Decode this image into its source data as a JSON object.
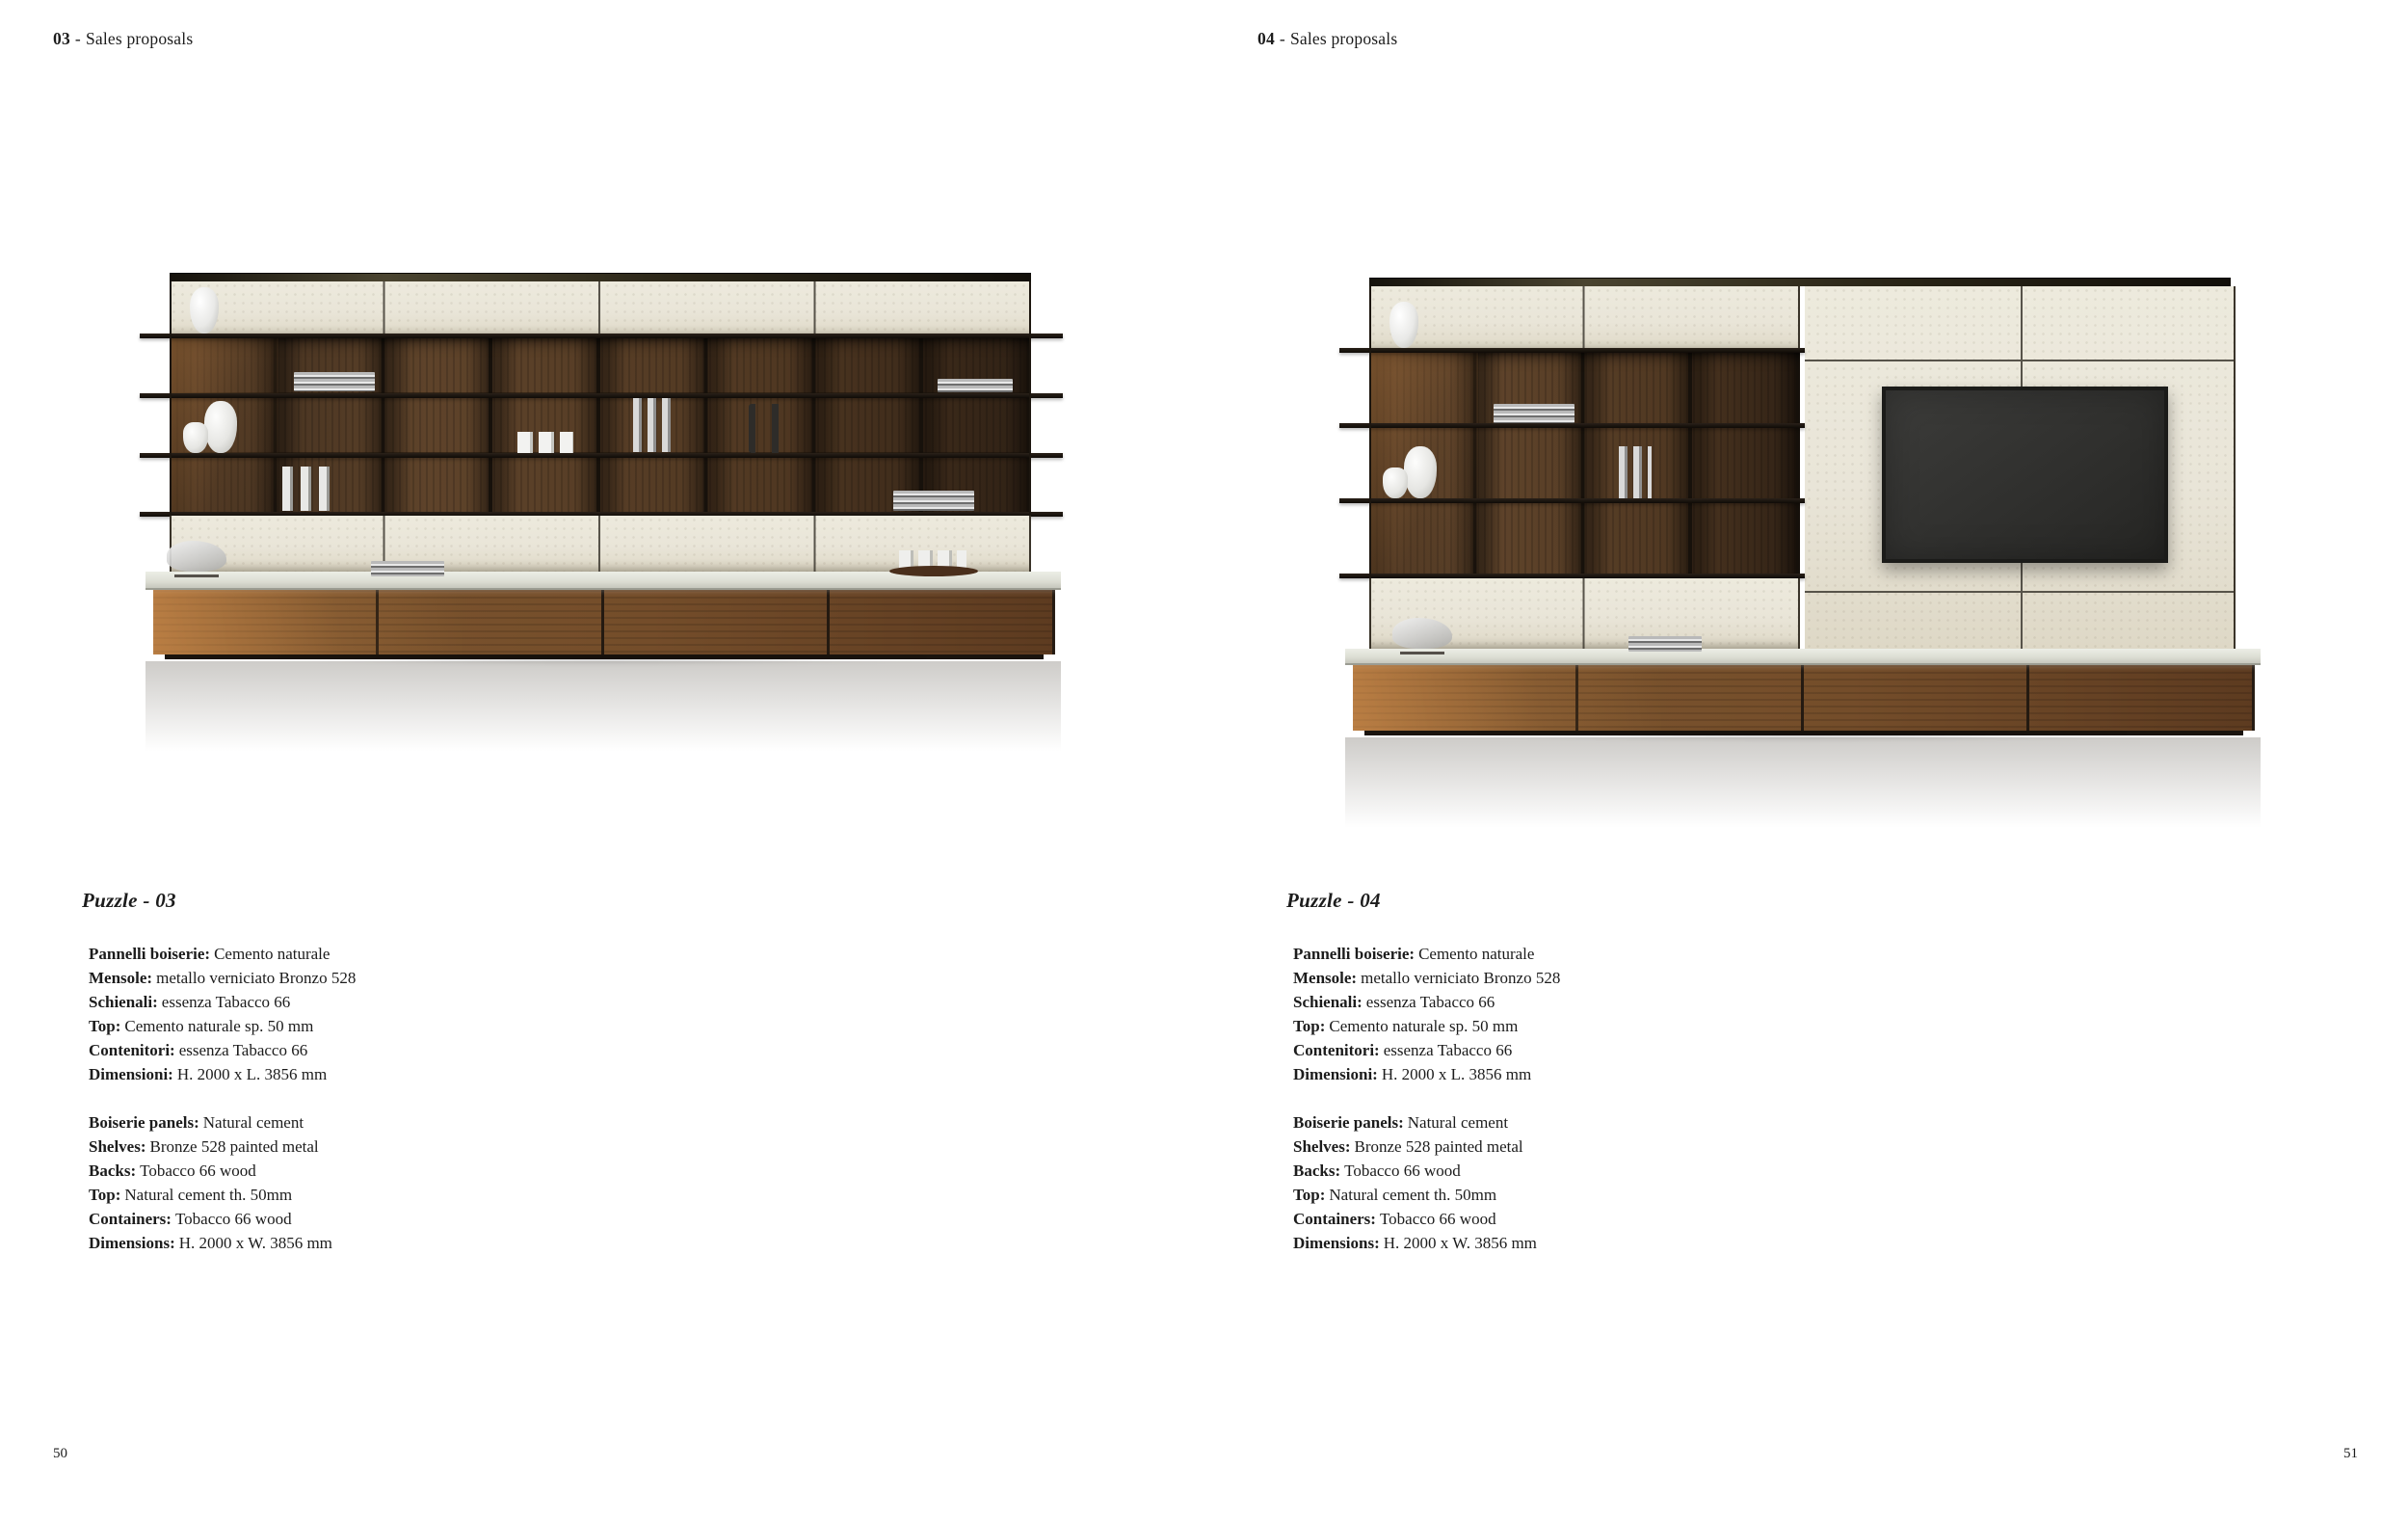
{
  "colors": {
    "page_bg": "#ffffff",
    "text": "#1c1c1c",
    "cream_panel": "#e9e5d8",
    "panel_seam": "#57534a",
    "cell_wood": "#5e432a",
    "cell_shadow": "#1d140d",
    "shelf_metal": "#17110b",
    "top_strip_olive": "#4a4430",
    "countertop": "#dcddd3",
    "base_wood": "#744d2a",
    "sunlight": "#eb9e54",
    "tv_screen": "#323230",
    "tv_frame": "#1b1b19"
  },
  "pages": [
    {
      "header": {
        "number": "03",
        "separator": "-",
        "label": "Sales proposals"
      },
      "product_title": "Puzzle - 03",
      "specs_italian": [
        {
          "label": "Pannelli boiserie:",
          "value": "Cemento naturale"
        },
        {
          "label": "Mensole:",
          "value": "metallo verniciato Bronzo 528"
        },
        {
          "label": "Schienali:",
          "value": "essenza Tabacco 66"
        },
        {
          "label": "Top:",
          "value": "Cemento naturale sp. 50 mm"
        },
        {
          "label": "Contenitori:",
          "value": "essenza Tabacco 66"
        },
        {
          "label": "Dimensioni:",
          "value": "H. 2000 x L. 3856 mm"
        }
      ],
      "specs_english": [
        {
          "label": "Boiserie panels:",
          "value": "Natural cement"
        },
        {
          "label": "Shelves:",
          "value": "Bronze 528 painted metal"
        },
        {
          "label": "Backs:",
          "value": "Tobacco 66 wood"
        },
        {
          "label": "Top:",
          "value": "Natural cement th. 50mm"
        },
        {
          "label": "Containers:",
          "value": "Tobacco 66 wood"
        },
        {
          "label": "Dimensions:",
          "value": "H. 2000 x W. 3856 mm"
        }
      ],
      "page_number": "50"
    },
    {
      "header": {
        "number": "04",
        "separator": "-",
        "label": "Sales proposals"
      },
      "product_title": "Puzzle - 04",
      "specs_italian": [
        {
          "label": "Pannelli boiserie:",
          "value": "Cemento naturale"
        },
        {
          "label": "Mensole:",
          "value": "metallo verniciato Bronzo 528"
        },
        {
          "label": "Schienali:",
          "value": "essenza Tabacco 66"
        },
        {
          "label": "Top:",
          "value": "Cemento naturale sp. 50 mm"
        },
        {
          "label": "Contenitori:",
          "value": "essenza Tabacco 66"
        },
        {
          "label": "Dimensioni:",
          "value": "H. 2000 x L. 3856 mm"
        }
      ],
      "specs_english": [
        {
          "label": "Boiserie panels:",
          "value": "Natural cement"
        },
        {
          "label": "Shelves:",
          "value": "Bronze 528 painted metal"
        },
        {
          "label": "Backs:",
          "value": "Tobacco 66 wood"
        },
        {
          "label": "Top:",
          "value": "Natural cement th. 50mm"
        },
        {
          "label": "Containers:",
          "value": "Tobacco 66 wood"
        },
        {
          "label": "Dimensions:",
          "value": "H. 2000 x W. 3856 mm"
        }
      ],
      "page_number": "51"
    }
  ]
}
